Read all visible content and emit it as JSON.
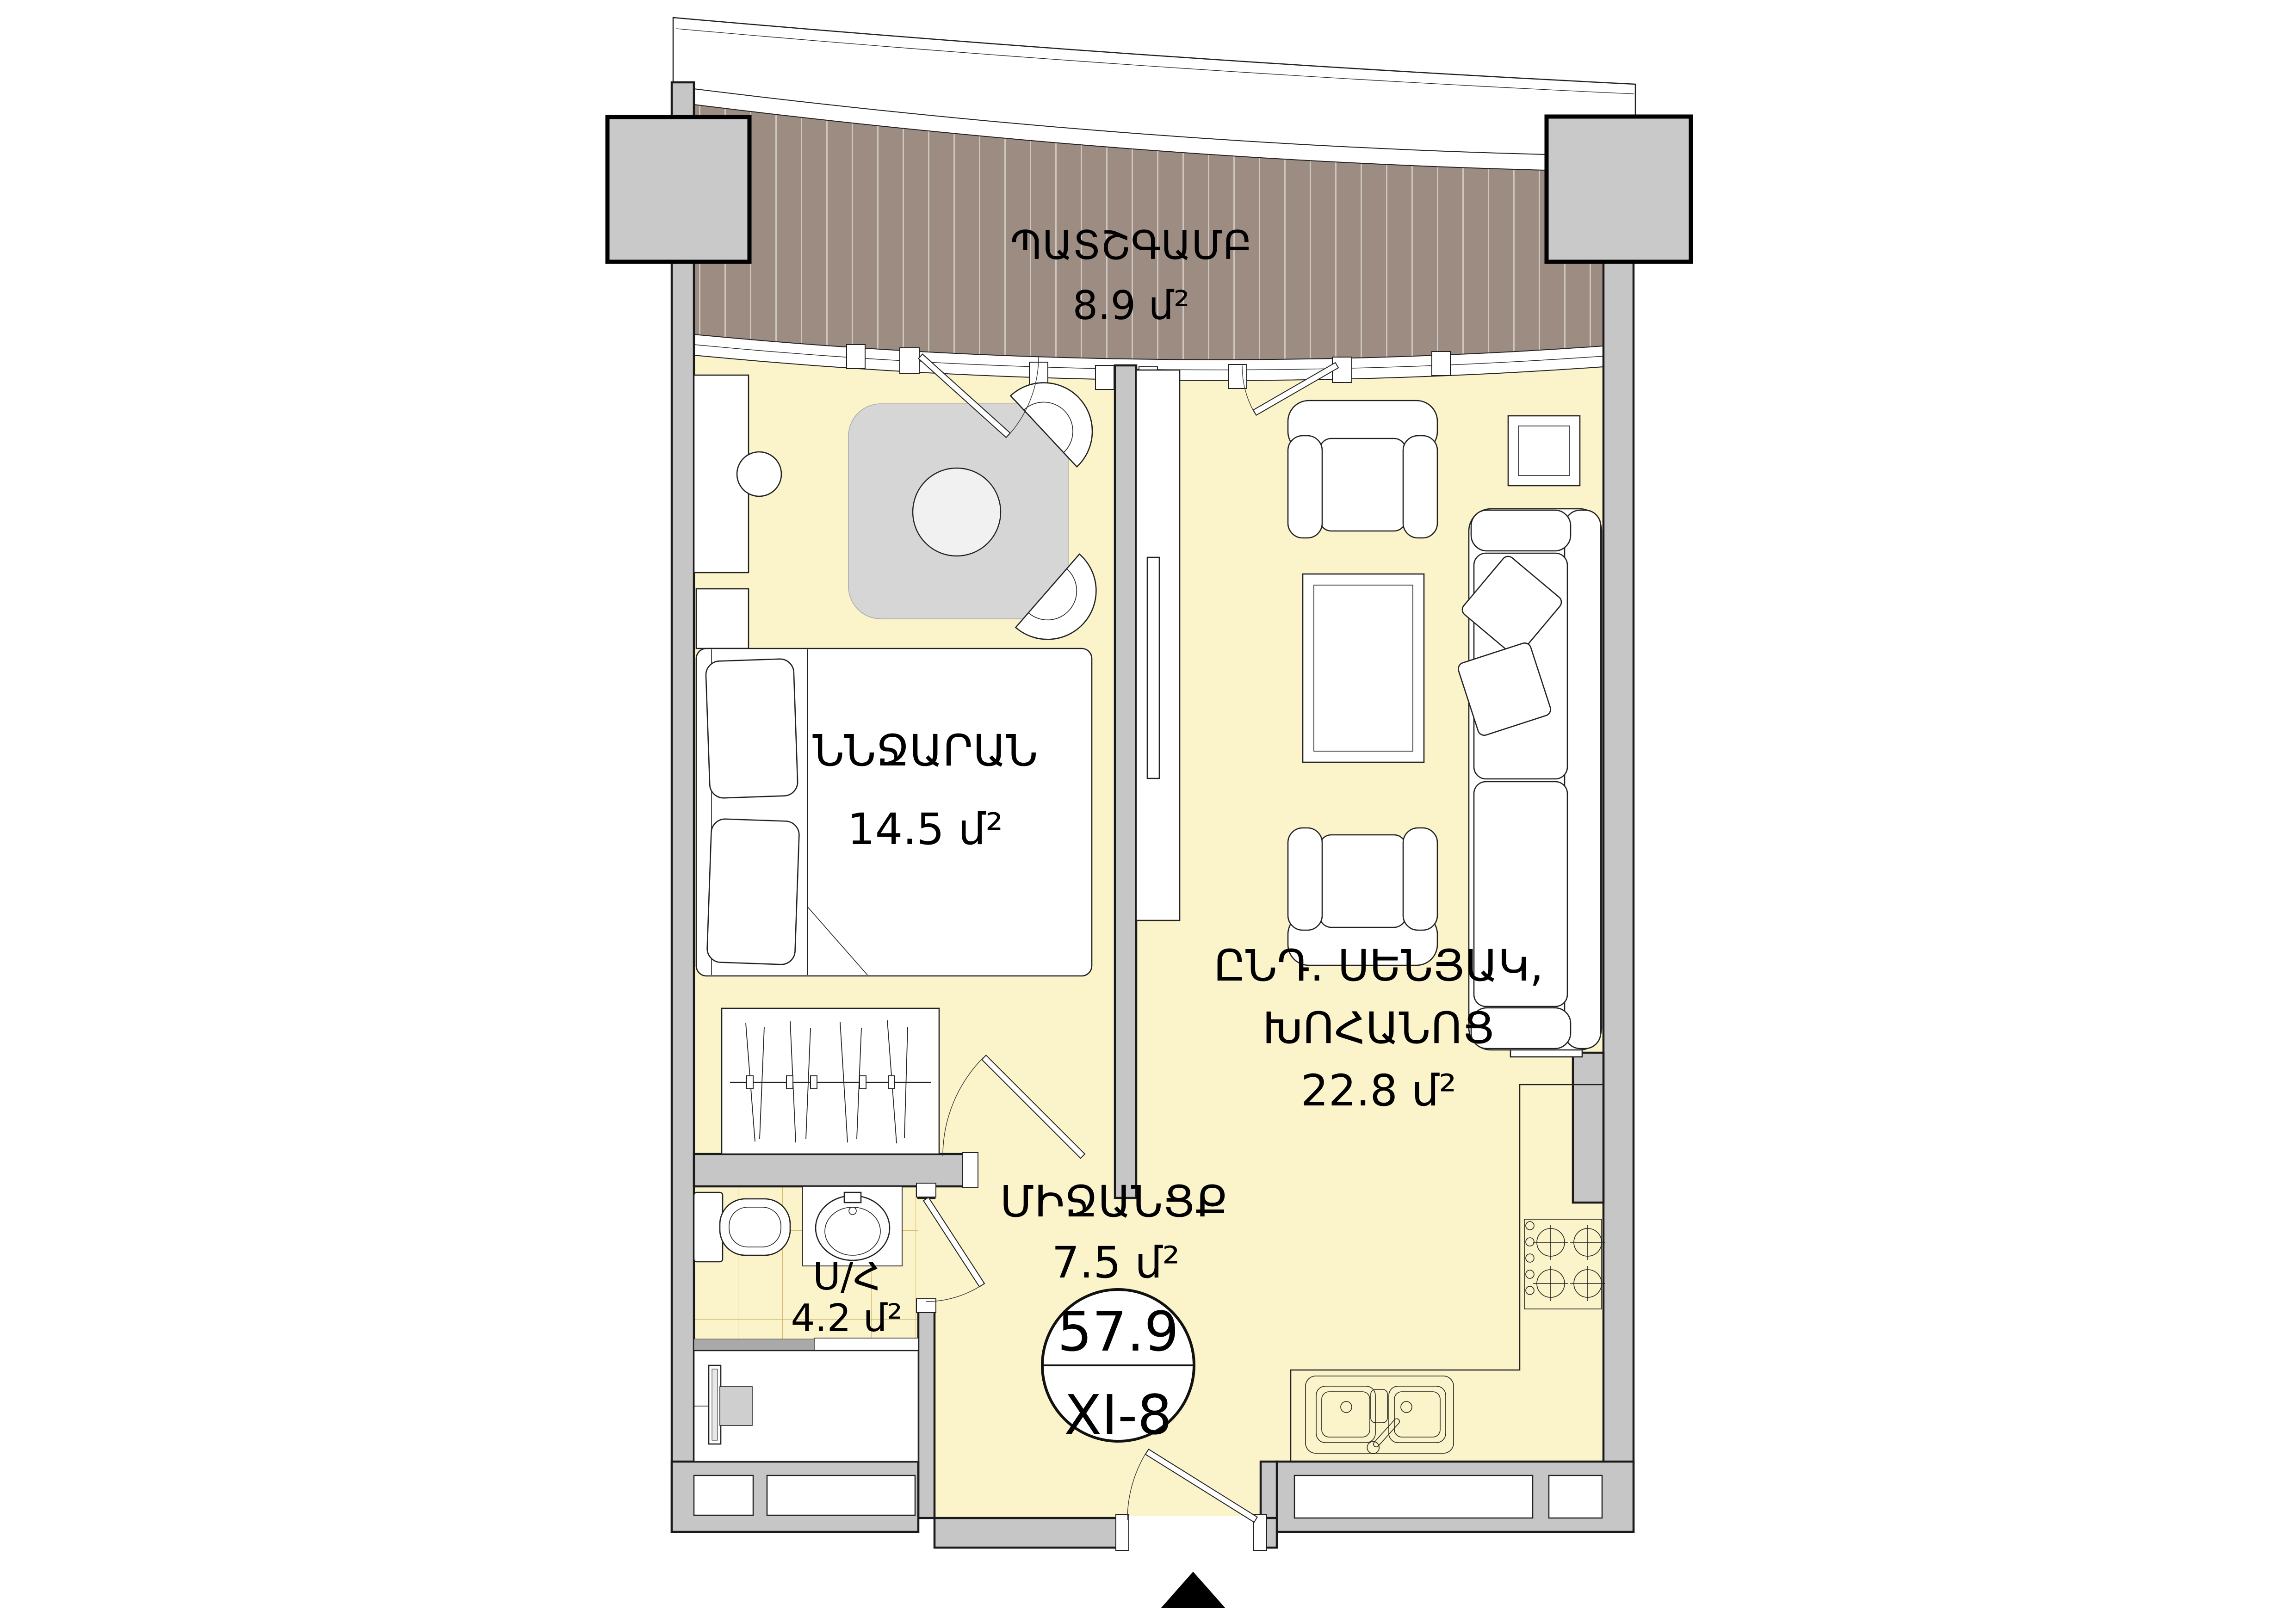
{
  "plan": {
    "balcony": {
      "label": "ՊԱՏՇԳԱՄԲ",
      "area": "8.9 մ²"
    },
    "bedroom": {
      "label": "ՆՆՋԱՐԱՆ",
      "area": "14.5 մ²"
    },
    "living_kitchen": {
      "label_line1": "ԸՆԴ. ՍԵՆՅԱԿ,",
      "label_line2": "ԽՈՀԱՆՈՑ",
      "area": "22.8 մ²"
    },
    "bathroom": {
      "label": "Ս/Հ",
      "area": "4.2 մ²"
    },
    "hallway": {
      "label": "ՄԻՋԱՆՑՔ",
      "area": "7.5 մ²"
    },
    "unit_badge": {
      "total_area": "57.9",
      "unit_number": "XI-8"
    },
    "colors": {
      "floor": "#fbf4ca",
      "wall": "#c6c6c6",
      "deck": "#9c8c82",
      "tile_line": "#c1983f"
    }
  }
}
